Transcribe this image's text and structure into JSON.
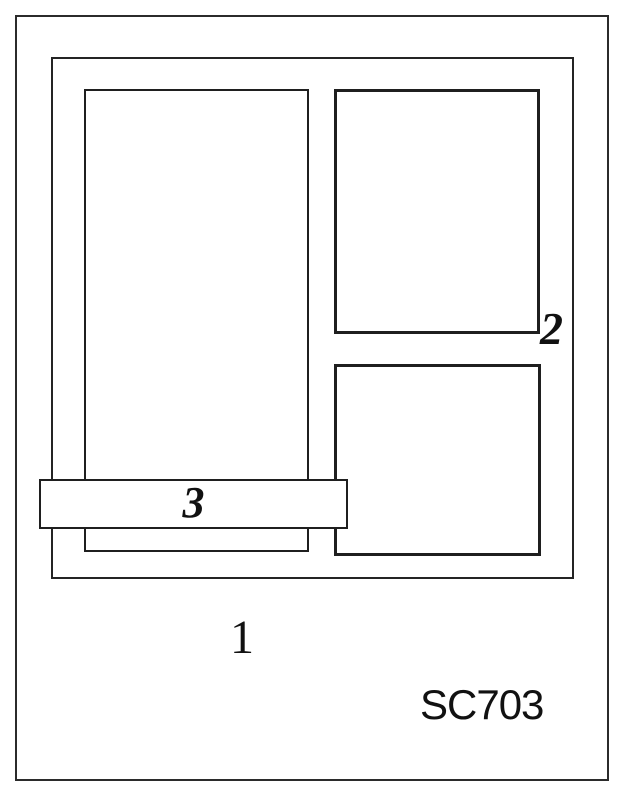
{
  "title": "Card layout sketch",
  "colors": {
    "background": "#ffffff",
    "line": "#1f1f1f",
    "text": "#111111"
  },
  "sketch": {
    "code": "SC703",
    "labels": {
      "one": "1",
      "two": "2",
      "three": "3"
    }
  }
}
